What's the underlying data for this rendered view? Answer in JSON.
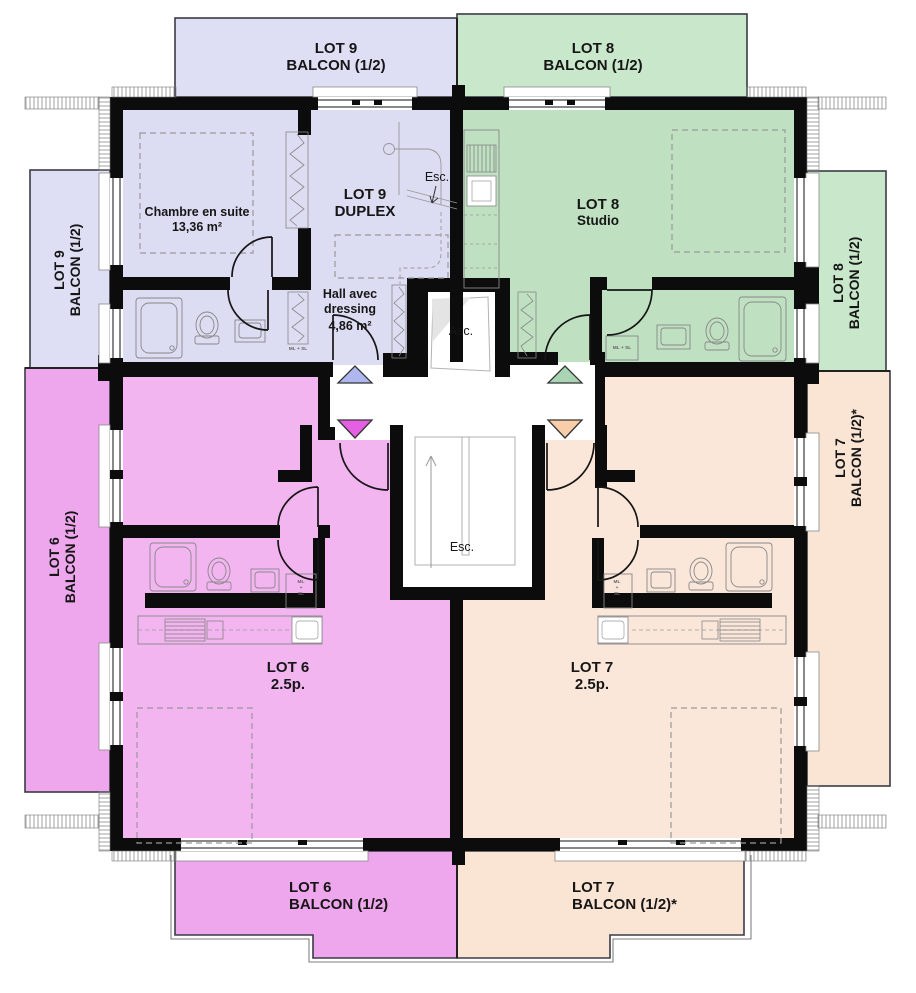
{
  "colors": {
    "wall": "#0c0c0c",
    "lot9_interior": "#dcdcf2",
    "lot9_balcony": "#dedef5",
    "lot8_interior": "#bfe0c1",
    "lot8_balcony": "#c9e7ca",
    "lot6_interior": "#f2b5f0",
    "lot6_balcony": "#eea6ec",
    "lot7_interior": "#fbe7da",
    "lot7_balcony": "#fae4d4",
    "triangle_lot9": "#aeb7ee",
    "triangle_lot8": "#a9d5b5",
    "triangle_lot6": "#e55fe2",
    "triangle_lot7": "#f8cda7"
  },
  "balconies": {
    "top_left": {
      "lot": "LOT 9",
      "label": "BALCON (1/2)"
    },
    "top_right": {
      "lot": "LOT 8",
      "label": "BALCON (1/2)"
    },
    "left_upper": {
      "lot": "LOT 9",
      "label": "BALCON (1/2)"
    },
    "left_lower": {
      "lot": "LOT 6",
      "label": "BALCON (1/2)"
    },
    "right_upper": {
      "lot": "LOT 8",
      "label": "BALCON (1/2)"
    },
    "right_lower": {
      "lot": "LOT 7",
      "label": "BALCON (1/2)*"
    },
    "bottom_left": {
      "lot": "LOT 6",
      "label": "BALCON (1/2)"
    },
    "bottom_right": {
      "lot": "LOT 7",
      "label": "BALCON (1/2)*"
    }
  },
  "units": {
    "lot9": {
      "name": "LOT 9",
      "type": "DUPLEX"
    },
    "lot8": {
      "name": "LOT 8",
      "type": "Studio"
    },
    "lot6": {
      "name": "LOT 6",
      "type": "2.5p."
    },
    "lot7": {
      "name": "LOT 7",
      "type": "2.5p."
    }
  },
  "rooms": {
    "chambre": {
      "name": "Chambre en suite",
      "area": "13,36 m²"
    },
    "hall": {
      "name": "Hall avec dressing",
      "area": "4,86 m²"
    }
  },
  "core": {
    "elevator": "Asc.",
    "stairs": "Esc.",
    "duplex_stairs": "Esc."
  },
  "closets": {
    "inline": "ML + SL",
    "stacked": [
      "ML",
      "+",
      "SL"
    ]
  }
}
